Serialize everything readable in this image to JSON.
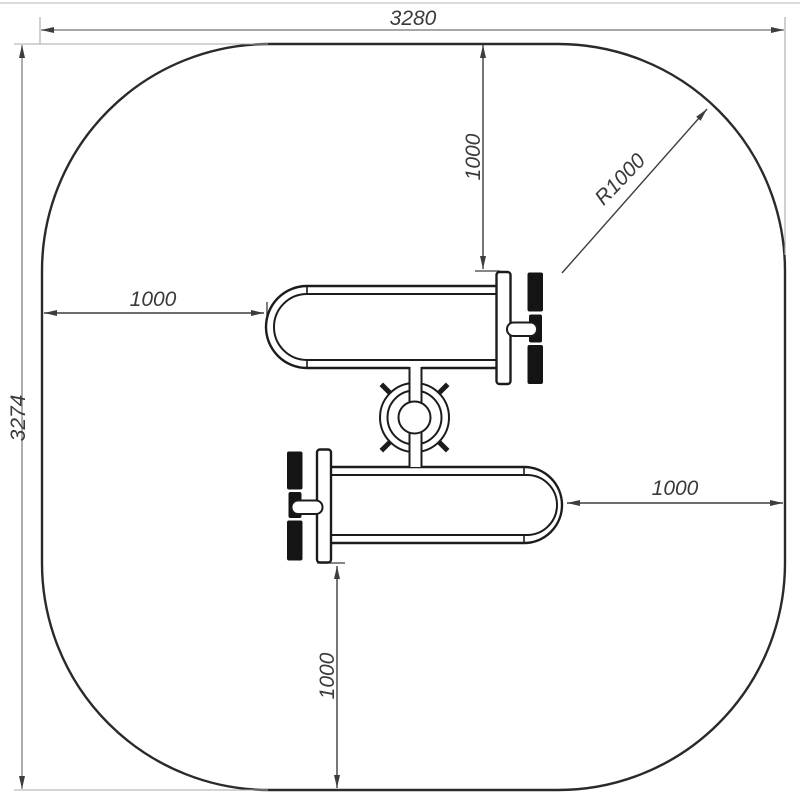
{
  "drawing": {
    "type": "technical-plan-drawing",
    "subject": "outdoor fitness equipment safety-zone top view",
    "dimensions": {
      "overall_width": "3280",
      "overall_height": "3274",
      "corner_radius": "R1000",
      "top_offset": "1000",
      "left_offset": "1000",
      "right_offset": "1000",
      "bottom_offset": "1000"
    },
    "colors": {
      "background": "#ffffff",
      "outline": "#2a2a2a",
      "equipment": "#1c1c1c",
      "dimension": "#3d3d3d",
      "outer_dimension": "#8a8a8a",
      "extension": "#a8a8a8",
      "pedal_fill": "#141414",
      "text": "#3a3a3a"
    }
  }
}
